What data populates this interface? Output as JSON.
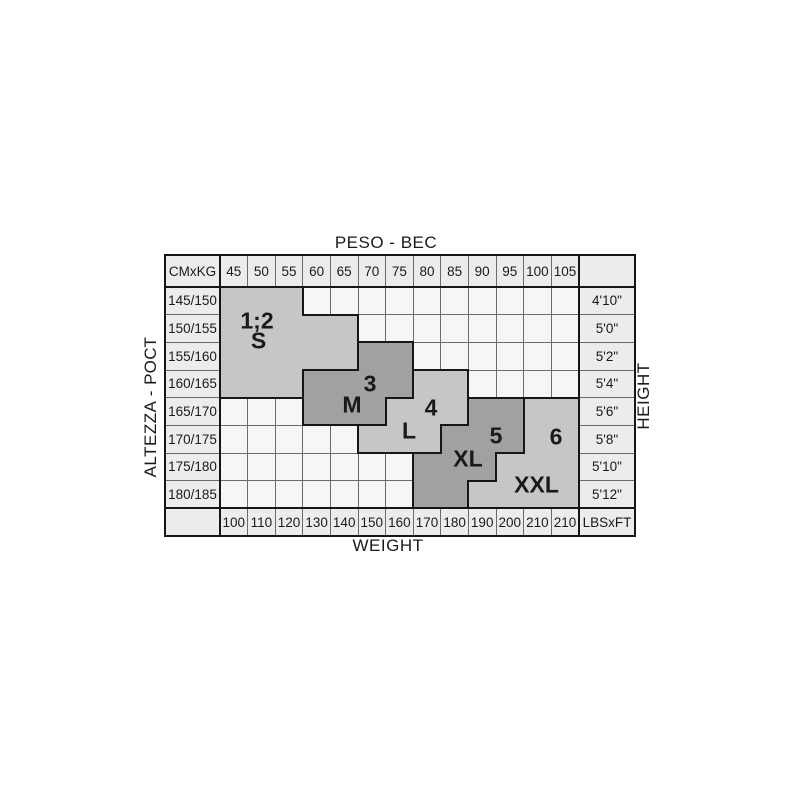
{
  "titles": {
    "top": "PESO - ВЕС",
    "bottom": "WEIGHT",
    "left": "ALTEZZA - РОСТ",
    "right": "HEIGHT"
  },
  "table": {
    "corner_top_left": "CMxKG",
    "corner_bottom_right": "LBSxFT",
    "kg_headers": [
      "45",
      "50",
      "55",
      "60",
      "65",
      "70",
      "75",
      "80",
      "85",
      "90",
      "95",
      "100",
      "105"
    ],
    "lbs_footers": [
      "100",
      "110",
      "120",
      "130",
      "140",
      "150",
      "160",
      "170",
      "180",
      "190",
      "200",
      "210",
      "210"
    ],
    "cm_rows": [
      "145/150",
      "150/155",
      "155/160",
      "160/165",
      "165/170",
      "170/175",
      "175/180",
      "180/185"
    ],
    "ft_rows": [
      "4'10\"",
      "5'0\"",
      "5'2\"",
      "5'4\"",
      "5'6\"",
      "5'8\"",
      "5'10\"",
      "5'12\""
    ]
  },
  "colors": {
    "label_cell_bg": "#ececec",
    "empty_cell_bg": "#f6f6f6",
    "light_region": "#c6c6c6",
    "dark_region": "#a1a1a1",
    "grid_line": "#6b6b6b",
    "frame_line": "#161616",
    "text": "#1a1a1a"
  },
  "regions": [
    {
      "id": "size-s",
      "number": "1;2",
      "letter": "S",
      "shade": "light",
      "rows": [
        [
          0,
          0,
          2
        ],
        [
          1,
          0,
          4
        ],
        [
          2,
          0,
          4
        ],
        [
          3,
          0,
          2
        ]
      ]
    },
    {
      "id": "size-m",
      "number": "3",
      "letter": "M",
      "shade": "dark",
      "rows": [
        [
          2,
          5,
          6
        ],
        [
          3,
          3,
          6
        ],
        [
          4,
          3,
          5
        ]
      ]
    },
    {
      "id": "size-l",
      "number": "4",
      "letter": "L",
      "shade": "light",
      "rows": [
        [
          3,
          7,
          8
        ],
        [
          4,
          6,
          8
        ],
        [
          5,
          5,
          7
        ]
      ]
    },
    {
      "id": "size-xl",
      "number": "5",
      "letter": "XL",
      "shade": "dark",
      "rows": [
        [
          4,
          9,
          10
        ],
        [
          5,
          8,
          10
        ],
        [
          6,
          7,
          9
        ],
        [
          7,
          7,
          8
        ]
      ]
    },
    {
      "id": "size-xxl",
      "number": "6",
      "letter": "XXL",
      "shade": "light",
      "rows": [
        [
          4,
          11,
          12
        ],
        [
          5,
          11,
          12
        ],
        [
          6,
          10,
          12
        ],
        [
          7,
          9,
          12
        ]
      ]
    }
  ],
  "chart_data": {
    "type": "heatmap",
    "title": "Size chart: PESO - ВЕС (weight, kg/lbs) vs ALTEZZA - РОСТ (height, cm/ft)",
    "x_kg": [
      45,
      50,
      55,
      60,
      65,
      70,
      75,
      80,
      85,
      90,
      95,
      100,
      105
    ],
    "x_lbs": [
      100,
      110,
      120,
      130,
      140,
      150,
      160,
      170,
      180,
      190,
      200,
      210,
      210
    ],
    "y_cm": [
      "145/150",
      "150/155",
      "155/160",
      "160/165",
      "165/170",
      "170/175",
      "175/180",
      "180/185"
    ],
    "y_ft": [
      "4'10\"",
      "5'0\"",
      "5'2\"",
      "5'4\"",
      "5'6\"",
      "5'8\"",
      "5'10\"",
      "5'12\""
    ],
    "grid": true,
    "sizes": [
      {
        "label": "1;2 S",
        "coverage": [
          {
            "height_cm": "145/150",
            "kg_range": [
              45,
              55
            ]
          },
          {
            "height_cm": "150/155",
            "kg_range": [
              45,
              65
            ]
          },
          {
            "height_cm": "155/160",
            "kg_range": [
              45,
              65
            ]
          },
          {
            "height_cm": "160/165",
            "kg_range": [
              45,
              55
            ]
          }
        ]
      },
      {
        "label": "3 M",
        "coverage": [
          {
            "height_cm": "155/160",
            "kg_range": [
              70,
              75
            ]
          },
          {
            "height_cm": "160/165",
            "kg_range": [
              60,
              75
            ]
          },
          {
            "height_cm": "165/170",
            "kg_range": [
              60,
              70
            ]
          }
        ]
      },
      {
        "label": "4 L",
        "coverage": [
          {
            "height_cm": "160/165",
            "kg_range": [
              80,
              85
            ]
          },
          {
            "height_cm": "165/170",
            "kg_range": [
              75,
              85
            ]
          },
          {
            "height_cm": "170/175",
            "kg_range": [
              70,
              80
            ]
          }
        ]
      },
      {
        "label": "5 XL",
        "coverage": [
          {
            "height_cm": "165/170",
            "kg_range": [
              90,
              95
            ]
          },
          {
            "height_cm": "170/175",
            "kg_range": [
              85,
              95
            ]
          },
          {
            "height_cm": "175/180",
            "kg_range": [
              80,
              90
            ]
          },
          {
            "height_cm": "180/185",
            "kg_range": [
              80,
              85
            ]
          }
        ]
      },
      {
        "label": "6 XXL",
        "coverage": [
          {
            "height_cm": "165/170",
            "kg_range": [
              100,
              105
            ]
          },
          {
            "height_cm": "170/175",
            "kg_range": [
              100,
              105
            ]
          },
          {
            "height_cm": "175/180",
            "kg_range": [
              95,
              105
            ]
          },
          {
            "height_cm": "180/185",
            "kg_range": [
              90,
              105
            ]
          }
        ]
      }
    ]
  }
}
